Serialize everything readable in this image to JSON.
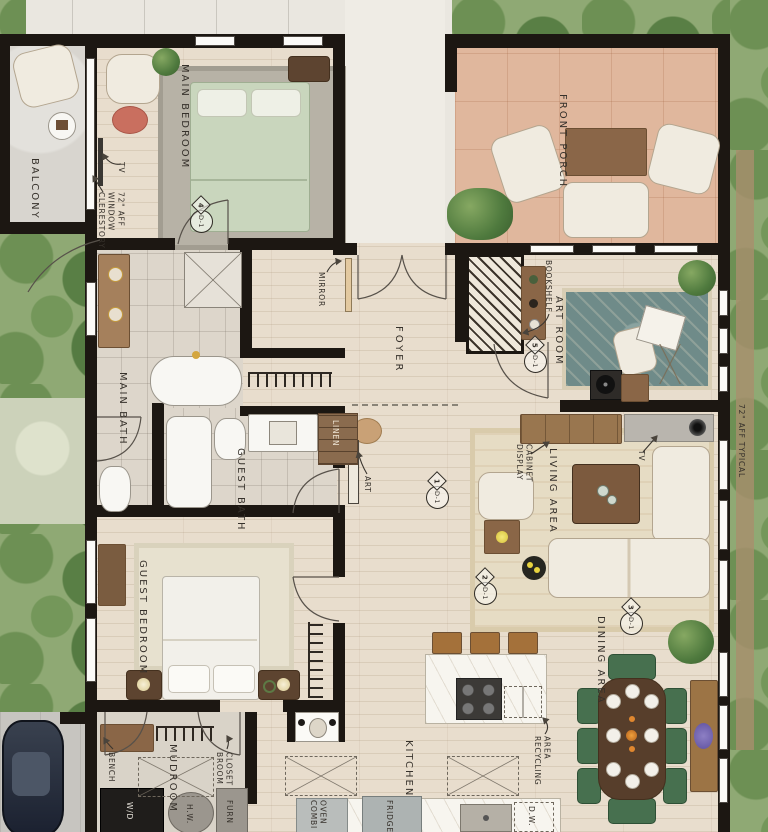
{
  "plan": {
    "rooms": {
      "balcony": "BALCONY",
      "main_bedroom": "MAIN BEDROOM",
      "front_porch": "FRONT PORCH",
      "foyer": "FOYER",
      "art_room": "ART ROOM",
      "main_bath": "MAIN BATH",
      "guest_bath": "GUEST BATH",
      "linen": "LINEN",
      "living_area": "LIVING AREA",
      "guest_bedroom": "GUEST BEDROOM",
      "mudroom": "MUDROOM",
      "kitchen": "KITCHEN",
      "dining_area": "DINING AREA"
    },
    "annotations": {
      "tv_bedroom": "TV",
      "clerestory_note": "CLERESTORY\nWINDOW\n72\" AFF",
      "mirror": "MIRROR",
      "bookshelf": "BOOKSHELF",
      "art": "ART",
      "display_cabinet": "DISPLAY\nCABINET",
      "tv_living": "TV",
      "aff_note": "72\" AFF TYPICAL",
      "bench": "BENCH",
      "broom_closet": "BROOM\nCLOSET",
      "recycling_area": "RECYCLING\nAREA",
      "fridge": "FRIDGE",
      "dishwasher": "D.W.",
      "combi_oven": "COMBI\nOVEN",
      "furnace": "FURN",
      "hot_water": "H.W.",
      "washer_dryer": "W/D"
    },
    "door_tags": [
      {
        "id": "D-1",
        "num": "1"
      },
      {
        "id": "D-1",
        "num": "2"
      },
      {
        "id": "D-1",
        "num": "3"
      },
      {
        "id": "D-1",
        "num": "4"
      },
      {
        "id": "D-1",
        "num": "5"
      }
    ]
  }
}
